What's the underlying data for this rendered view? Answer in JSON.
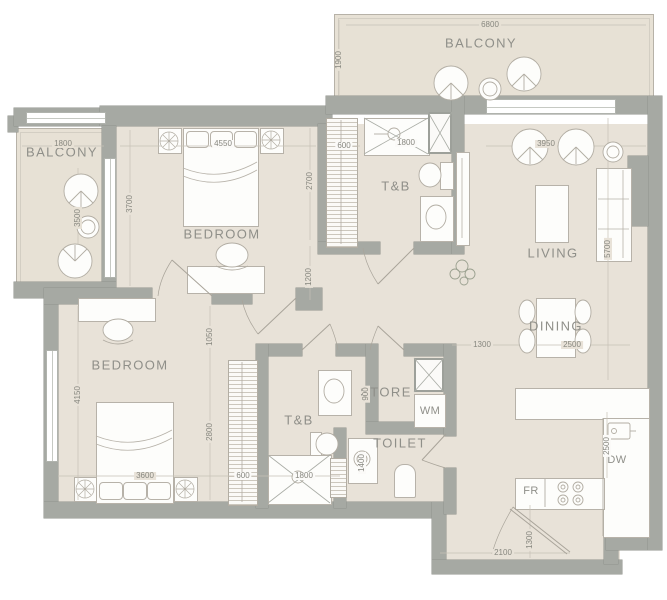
{
  "rooms": {
    "balconyTop": "BALCONY",
    "balconyLeft": "BALCONY",
    "bedroom1": "BEDROOM",
    "tb1": "T&B",
    "living": "LIVING",
    "dining": "DINING",
    "bedroom2": "BEDROOM",
    "tb2": "T&B",
    "store": "STORE",
    "toilet": "TOILET",
    "wm": "WM",
    "fr": "FR",
    "dw": "DW"
  },
  "dims": {
    "balconyTopWidth": "6800",
    "balconyTopDepth": "1900",
    "balconyLeftWidth": "1800",
    "balconyLeftDepth": "3500",
    "bedroom1Width": "4550",
    "bedroom1Side": "3700",
    "bedroom1Right": "2700",
    "bedroom1RightLower": "1200",
    "tb1Closet": "600",
    "tb1Shower": "1800",
    "livingWidth": "3950",
    "livingDepth": "5700",
    "diningLeft": "1300",
    "diningWidth": "2500",
    "bedroom2Side": "4150",
    "bedroom2RightUpper": "1050",
    "bedroom2RightLower": "2800",
    "bedroom2Bed": "3600",
    "bedroom2Closet": "600",
    "tb2Shower": "1800",
    "toiletVanity": "1400",
    "storeDepth": "900",
    "kitchenDepth": "2500",
    "entryWidth": "2100",
    "entryDepth": "1300"
  },
  "colors": {
    "wall": "#a6a9a3",
    "floor": "#e8e2d8",
    "line": "#b5b0a6",
    "text": "#8f8f89"
  }
}
